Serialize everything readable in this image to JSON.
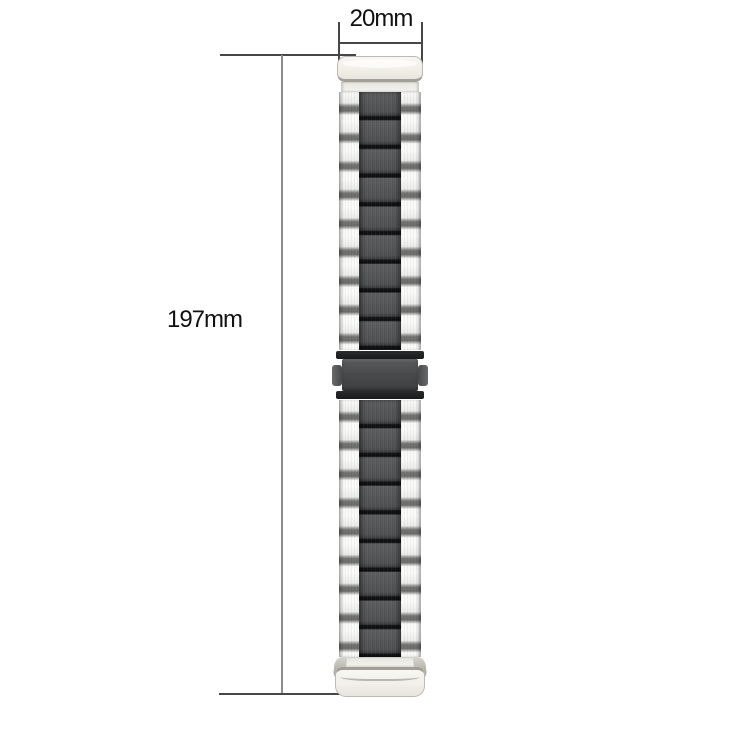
{
  "dimensions": {
    "width": {
      "label": "20mm"
    },
    "length": {
      "label": "197mm"
    }
  },
  "colors": {
    "background": "#ffffff",
    "label_text": "#111111",
    "dimension_line": "#474747",
    "extension_line": "#8c8c8c",
    "link_light": "#f2f2f0",
    "link_light_stripe": "#747472",
    "link_dark": "#4e4f51",
    "link_dark_separator": "#141517",
    "end_cap": "#f1efe8",
    "end_cap_edge": "#a19f96",
    "clasp_body": "#4a4b4d",
    "clasp_bar": "#1a1b1d"
  }
}
